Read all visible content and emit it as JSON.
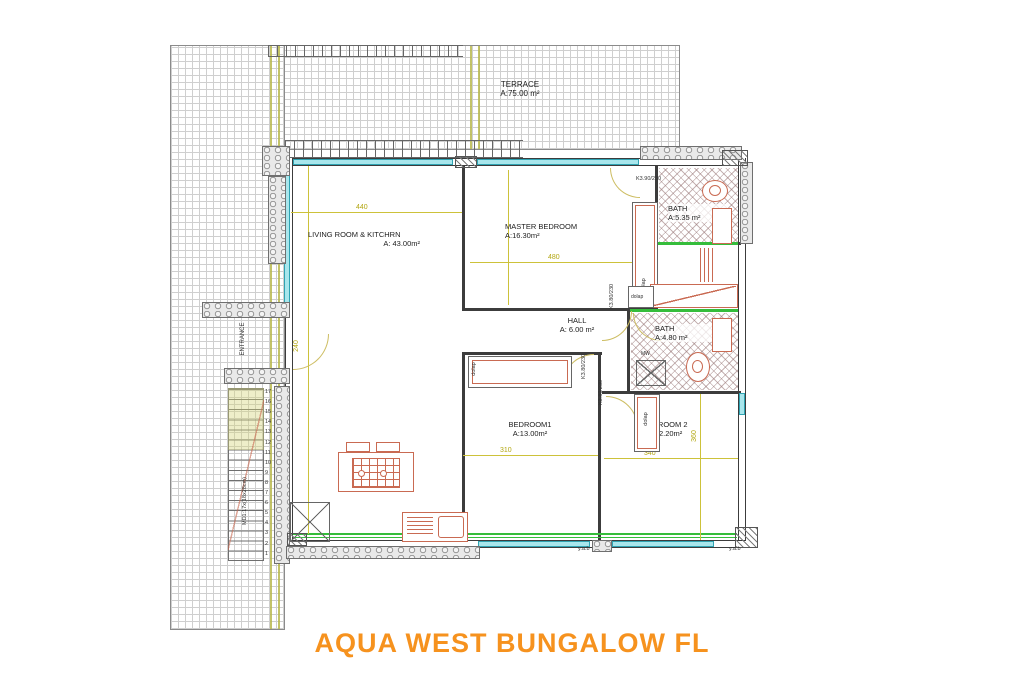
{
  "title": {
    "text": "AQUA WEST BUNGALOW FL",
    "color": "#F6921E"
  },
  "terrace": {
    "name": "TERRACE",
    "area": "A:75.00 m²"
  },
  "rooms": {
    "living": {
      "name": "LIVING ROOM & KITCHRN",
      "area": "A: 43.00m²"
    },
    "master": {
      "name": "MASTER BEDROOM",
      "area": "A:16.30m²"
    },
    "bath1": {
      "name": "BATH",
      "area": "A:5.35 m²"
    },
    "hall": {
      "name": "HALL",
      "area": "A: 6.00 m²"
    },
    "bath2": {
      "name": "BATH",
      "area": "A:4.80 m²"
    },
    "bedroom1": {
      "name": "BEDROOM1",
      "area": "A:13.00m²"
    },
    "bedroom2": {
      "name": "BEDROOM 2",
      "area": "A:12.20m²"
    }
  },
  "dimensions": {
    "living_width": "440",
    "master_width": "480",
    "bedroom1_width": "310",
    "bedroom2_width": "340",
    "bedroom2_height": "360",
    "entrance_width": "240"
  },
  "annotations": {
    "entrance": "ENTRANCE",
    "stair_spec": "MD1:17x(18x28cm)",
    "door_top": "K3.90/230",
    "door_a": "K3.80/230",
    "door_b": "K3.80/230",
    "door_c": "K3.80/230",
    "wardrobe_master": "dolap",
    "wardrobe_bath": "dolap",
    "wardrobe_bedroom1": "dolap",
    "wardrobe_bedroom2": "dolap",
    "mw": "MW",
    "yab_left": "y.a.b",
    "yab_right": "y.a.b"
  },
  "stairs": {
    "steps": [
      "17",
      "16",
      "15",
      "14",
      "13",
      "12",
      "11",
      "10",
      "9",
      "8",
      "7",
      "6",
      "5",
      "4",
      "3",
      "2",
      "1"
    ]
  }
}
